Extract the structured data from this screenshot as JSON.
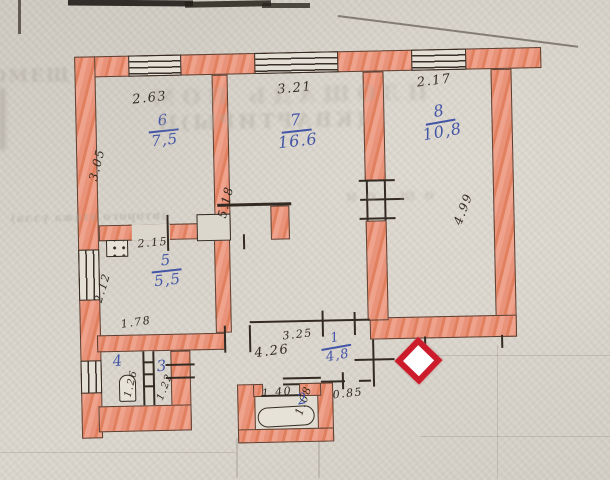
{
  "document": {
    "kind": "hand-drawn apartment floor plan (scanned technical passport fragment)",
    "units_note": "room numbers over areas in blue ink, wall dimensions in metres in pencil"
  },
  "colors": {
    "paper": "#d7d3ca",
    "wall_crayon": "#e99179",
    "pencil_line": "#332b23",
    "blue_ink": "#4355a6",
    "diamond_marker_border": "#cc1b2a",
    "diamond_marker_fill": "#ffffff"
  },
  "rooms": [
    {
      "number": "6",
      "area": "7,5",
      "x": 136,
      "y": 110,
      "w": 60,
      "rot": -5,
      "size": 15
    },
    {
      "number": "7",
      "area": "16.6",
      "x": 266,
      "y": 112,
      "w": 66,
      "rot": -5,
      "size": 16
    },
    {
      "number": "8",
      "area": "10,8",
      "x": 410,
      "y": 106,
      "w": 66,
      "rot": -9,
      "size": 16
    },
    {
      "number": "5",
      "area": "5,5",
      "x": 136,
      "y": 250,
      "w": 60,
      "rot": -5,
      "size": 15
    },
    {
      "number": "1",
      "area": "4,8",
      "x": 308,
      "y": 332,
      "w": 52,
      "rot": -9,
      "size": 13
    },
    {
      "number": "4",
      "area": null,
      "x": 100,
      "y": 350,
      "w": 26,
      "rot": -6,
      "size": 15
    },
    {
      "number": "3",
      "area": null,
      "x": 144,
      "y": 356,
      "w": 26,
      "rot": -6,
      "size": 15
    },
    {
      "number": "2",
      "area": null,
      "x": 284,
      "y": 392,
      "w": 26,
      "rot": -10,
      "size": 15
    }
  ],
  "dims": [
    {
      "text": "2.63",
      "x": 136,
      "y": 104,
      "rot": -5,
      "size": 13
    },
    {
      "text": "3.21",
      "x": 281,
      "y": 97,
      "rot": -4,
      "size": 13
    },
    {
      "text": "2.17",
      "x": 421,
      "y": 93,
      "rot": -6,
      "size": 13
    },
    {
      "text": "3.05",
      "x": 101,
      "y": 178,
      "rot": -75,
      "size": 12
    },
    {
      "text": "5.18",
      "x": 229,
      "y": 218,
      "rot": -75,
      "size": 12
    },
    {
      "text": "4.99",
      "x": 464,
      "y": 230,
      "rot": -68,
      "size": 12
    },
    {
      "text": "2.15",
      "x": 138,
      "y": 247,
      "rot": -4,
      "size": 11
    },
    {
      "text": "2.12",
      "x": 103,
      "y": 300,
      "rot": -72,
      "size": 11
    },
    {
      "text": "1.78",
      "x": 120,
      "y": 327,
      "rot": -7,
      "size": 11
    },
    {
      "text": "3.25",
      "x": 281,
      "y": 342,
      "rot": -5,
      "size": 11
    },
    {
      "text": "4.26",
      "x": 253,
      "y": 360,
      "rot": -6,
      "size": 13
    },
    {
      "text": "1.40",
      "x": 259,
      "y": 399,
      "rot": -4,
      "size": 11
    },
    {
      "text": "1.08",
      "x": 301,
      "y": 417,
      "rot": -70,
      "size": 11
    },
    {
      "text": "0.85",
      "x": 330,
      "y": 402,
      "rot": -5,
      "size": 11
    },
    {
      "text": "1.26",
      "x": 130,
      "y": 396,
      "rot": -75,
      "size": 10
    },
    {
      "text": "1.22",
      "x": 162,
      "y": 400,
      "rot": -68,
      "size": 10
    }
  ],
  "bleed_text_fragments": [
    {
      "text": "ОМЕЩ",
      "x": -6,
      "y": 60,
      "size": 18,
      "ls": 2,
      "mirror": false,
      "opacity": 0.5,
      "blur": 1.2
    },
    {
      "text": "ПЛОЩАДЬ ПОМ",
      "x": 148,
      "y": 82,
      "size": 21,
      "ls": 7,
      "mirror": true,
      "opacity": 0.38,
      "blur": 1.6
    },
    {
      "text": "(КВАРТИРЫ)Н",
      "x": 158,
      "y": 108,
      "size": 20,
      "ls": 3,
      "mirror": true,
      "opacity": 0.42,
      "blur": 1.3
    },
    {
      "text": "(второго этажа узла)",
      "x": 10,
      "y": 206,
      "size": 11,
      "ls": 1,
      "mirror": true,
      "opacity": 0.5,
      "blur": 0.8
    },
    {
      "text": "ош  он",
      "x": 338,
      "y": 188,
      "size": 15,
      "ls": 9,
      "mirror": true,
      "opacity": 0.38,
      "blur": 1.2
    }
  ],
  "marker": {
    "shape": "red diamond with white centre",
    "callout": "leader line pointing to corridor (room 1)"
  }
}
